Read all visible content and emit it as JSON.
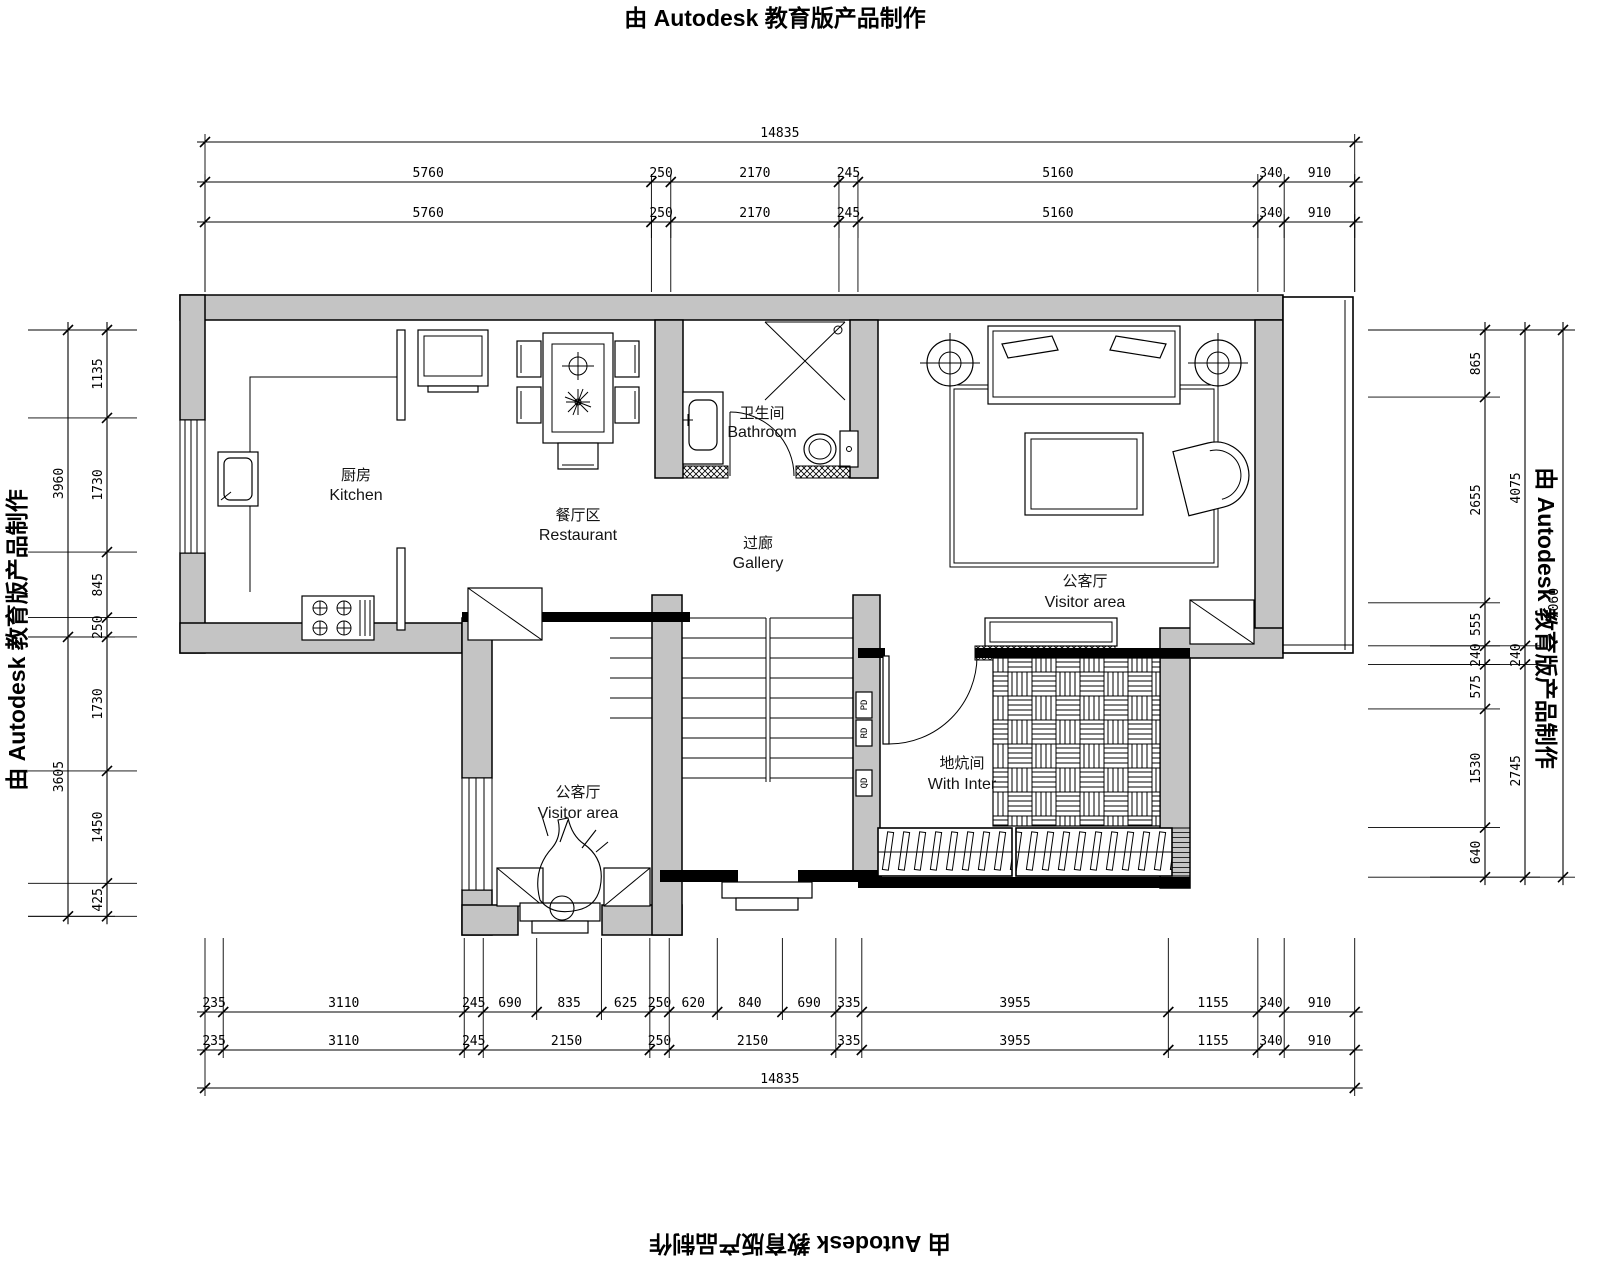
{
  "edge_title": {
    "text": "由 Autodesk 教育版产品制作"
  },
  "rooms": {
    "kitchen": {
      "zh": "厨房",
      "en": "Kitchen"
    },
    "restaurant": {
      "zh": "餐厅区",
      "en": "Restaurant"
    },
    "bathroom": {
      "zh": "卫生间",
      "en": "Bathroom"
    },
    "gallery": {
      "zh": "过廊",
      "en": "Gallery"
    },
    "visitor_right": {
      "zh": "公客厅",
      "en": "Visitor area"
    },
    "visitor_lower": {
      "zh": "公客厅",
      "en": "Visitor area"
    },
    "heated_room": {
      "zh": "地炕间",
      "en": "With Inter"
    }
  },
  "wall_labels": {
    "pd": "PD",
    "rd": "RD",
    "qd": "QD"
  },
  "dimensions": {
    "overall_width": 14835,
    "top_row_1": [
      5760,
      250,
      2170,
      245,
      5160,
      340,
      910
    ],
    "top_row_2": [
      5760,
      250,
      2170,
      245,
      5160,
      340,
      910
    ],
    "bottom_row_upper": [
      235,
      3110,
      245,
      690,
      835,
      625,
      250,
      620,
      840,
      690,
      335,
      3955,
      1155,
      340,
      910
    ],
    "bottom_row_lower": [
      235,
      3110,
      245,
      2150,
      250,
      2150,
      335,
      3955,
      1155,
      340,
      910
    ],
    "left_inner": [
      1135,
      1730,
      845,
      250,
      1730,
      1450,
      425
    ],
    "left_outer": [
      3960,
      3605
    ],
    "right_inner": [
      865,
      2655,
      555,
      240,
      575,
      1530,
      640
    ],
    "right_middle": [
      4075,
      240,
      2745
    ],
    "right_outer": [
      7060
    ]
  }
}
